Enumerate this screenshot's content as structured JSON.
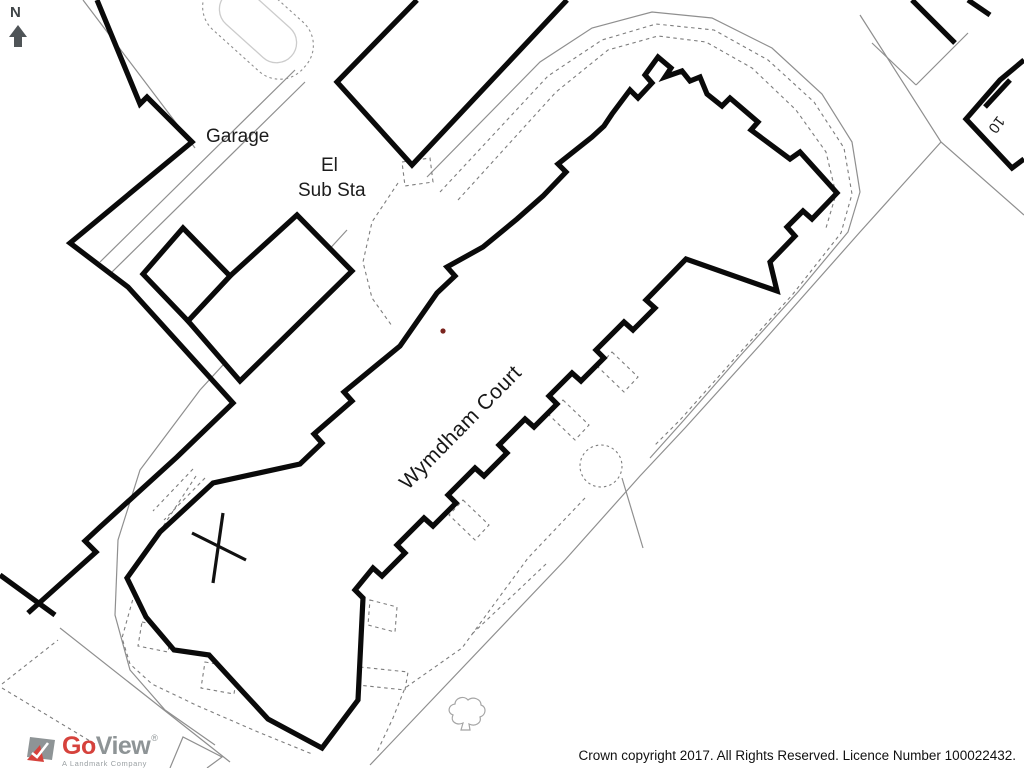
{
  "map": {
    "north_label": "N",
    "labels": {
      "garage": "Garage",
      "el": "El",
      "sub_sta": "Sub Sta",
      "building_name": "Wymdham Court",
      "house_number": "10"
    },
    "symbols": {
      "north_arrow": "north-arrow",
      "tree": "deciduous-tree",
      "x_mark": "x-mark",
      "red_dot": "red-dot-marker"
    },
    "colors": {
      "building_outline": "#0a0a0a",
      "thin_line": "#8f8f8f",
      "dashed_line": "#7d7d7d",
      "light_line": "#c9c9c9",
      "red_marker": "#7a241e",
      "north_arrow_gray": "#4f5457"
    }
  },
  "footer": {
    "copyright": "Crown copyright 2017. All Rights Reserved. Licence Number 100022432."
  },
  "logo": {
    "brand_primary": "Go",
    "brand_secondary": "View",
    "registered_mark": "®",
    "tagline": "A Landmark Company",
    "colors": {
      "red": "#d6423c",
      "gray": "#8e9496"
    }
  }
}
